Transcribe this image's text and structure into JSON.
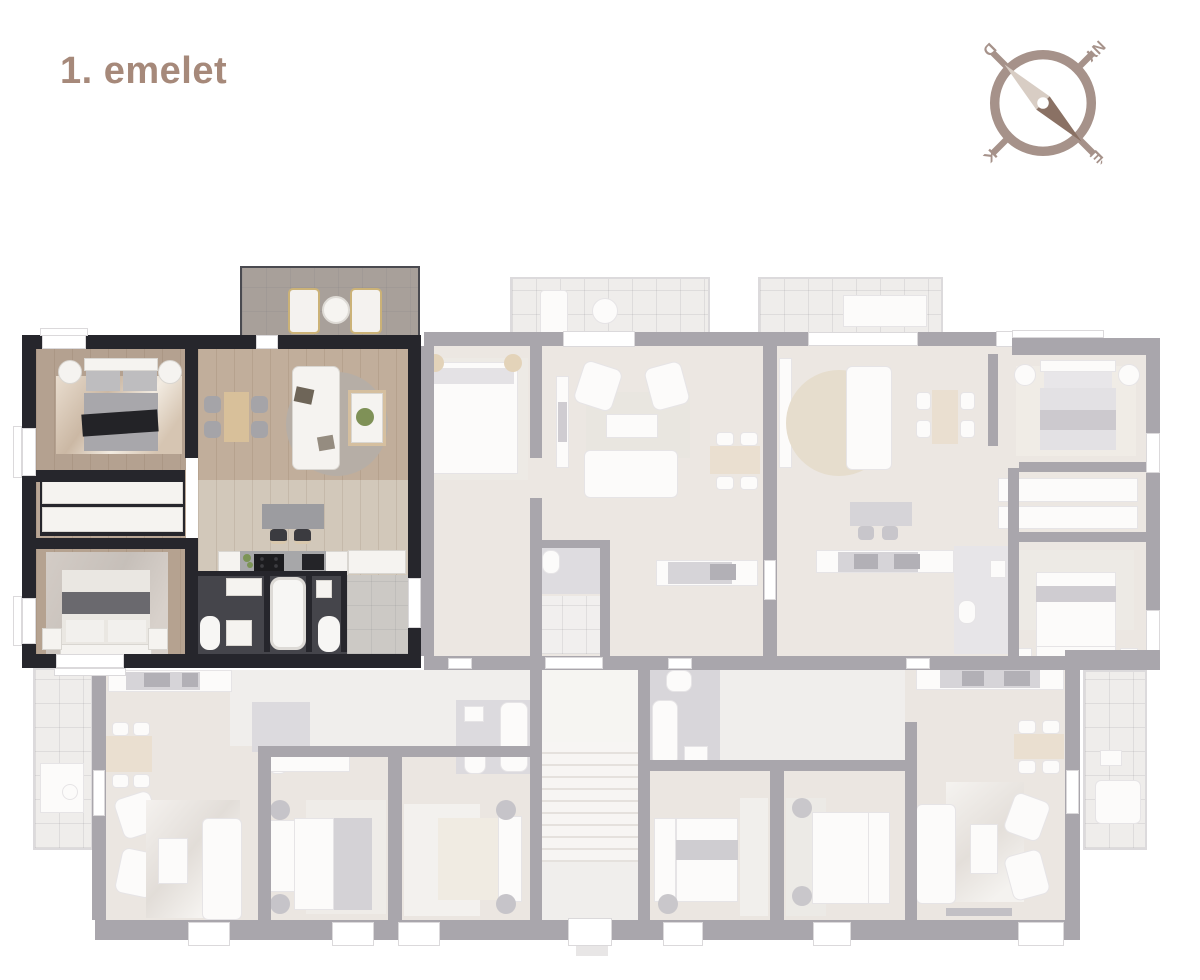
{
  "floor_label": "1. emelet",
  "compass": {
    "north": "É",
    "south": "D",
    "east": "K",
    "west": "NY"
  },
  "colors": {
    "background": "#ffffff",
    "accent": "#a6897a",
    "compass_body": "#a6928a",
    "needle_light": "#d8cdc4",
    "needle_dark": "#8a7164",
    "highlight_wall": "#26262c",
    "faded_wall": "#a9a6ac",
    "wood_floor": "#bfae9c",
    "bath_floor": "#45454b"
  }
}
